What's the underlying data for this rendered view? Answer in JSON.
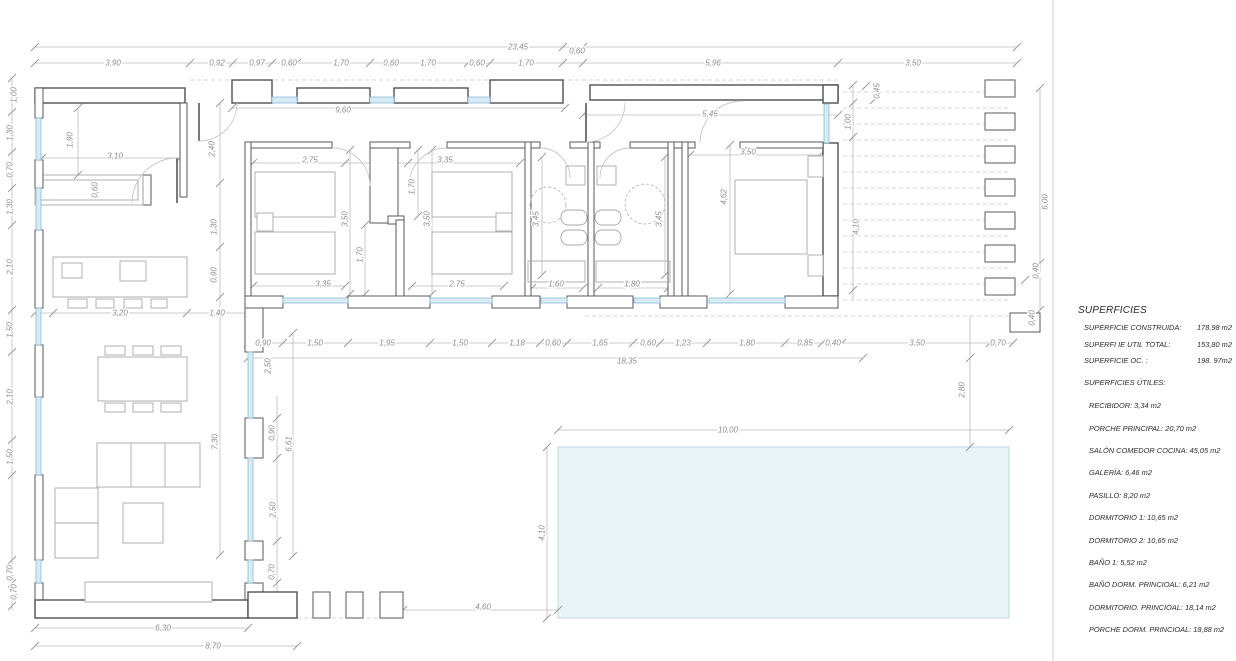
{
  "superficies": {
    "title": "SUPERFICIES",
    "summary": [
      {
        "label": "SUPERFICIE CONSTRUIDA:",
        "value": "178.98 m2"
      },
      {
        "label": "SUPERFI IE UTIL TOTAL:",
        "value": "153,80 m2"
      },
      {
        "label": "SUPERFICIE  OC. :",
        "value": "198. 97m2"
      }
    ],
    "utiles_title": "SUPERFICIES ÚTILES:",
    "rooms": [
      "RECIBIDOR: 3,34 m2",
      "PORCHE PRINCIPAL: 20,70 m2",
      "SALÓN COMEDOR COCINA: 45,05 m2",
      "GALERÍA: 6,46 m2",
      "PASILLO: 8,20 m2",
      "DORMITORIO 1: 10,65 m2",
      "DORMITORIO 2: 10,65 m2",
      "BAÑO 1: 5,52 m2",
      "BAÑO DORM. PRINCIOAL: 6,21 m2",
      "DORMITORIO. PRINCIOAL: 18,14 m2",
      "PORCHE DORM. PRINCIOAL: 18,88 m2"
    ]
  },
  "dimensions": [
    {
      "t": "23,45",
      "x": 518,
      "y": 47
    },
    {
      "t": "0,60",
      "x": 577,
      "y": 51
    },
    {
      "t": "3,90",
      "x": 113,
      "y": 63
    },
    {
      "t": "0,92",
      "x": 217,
      "y": 63
    },
    {
      "t": "0,97",
      "x": 257,
      "y": 63
    },
    {
      "t": "0,60",
      "x": 289,
      "y": 63
    },
    {
      "t": "1,70",
      "x": 341,
      "y": 63
    },
    {
      "t": "0,60",
      "x": 391,
      "y": 63
    },
    {
      "t": "1,70",
      "x": 428,
      "y": 63
    },
    {
      "t": "0,60",
      "x": 477,
      "y": 63
    },
    {
      "t": "1,70",
      "x": 526,
      "y": 63
    },
    {
      "t": "5,96",
      "x": 713,
      "y": 63
    },
    {
      "t": "3,50",
      "x": 913,
      "y": 63
    },
    {
      "t": "9,60",
      "x": 343,
      "y": 110
    },
    {
      "t": "5,45",
      "x": 710,
      "y": 114
    },
    {
      "t": "1,00",
      "x": 14,
      "y": 95,
      "r": -90
    },
    {
      "t": "1,30",
      "x": 10,
      "y": 133,
      "r": -90
    },
    {
      "t": "0,70",
      "x": 10,
      "y": 170,
      "r": -90
    },
    {
      "t": "1,30",
      "x": 10,
      "y": 207,
      "r": -90
    },
    {
      "t": "2,10",
      "x": 10,
      "y": 267,
      "r": -90
    },
    {
      "t": "1,50",
      "x": 10,
      "y": 330,
      "r": -90
    },
    {
      "t": "2,10",
      "x": 10,
      "y": 397,
      "r": -90
    },
    {
      "t": "1,50",
      "x": 10,
      "y": 457,
      "r": -90
    },
    {
      "t": "0,70",
      "x": 10,
      "y": 573,
      "r": -90
    },
    {
      "t": "0,70",
      "x": 14,
      "y": 592,
      "r": -90
    },
    {
      "t": "1,90",
      "x": 70,
      "y": 140,
      "r": -90
    },
    {
      "t": "3,10",
      "x": 115,
      "y": 156
    },
    {
      "t": "0,60",
      "x": 95,
      "y": 190,
      "r": -90
    },
    {
      "t": "2,40",
      "x": 212,
      "y": 149,
      "r": -90
    },
    {
      "t": "1,30",
      "x": 214,
      "y": 227,
      "r": -90
    },
    {
      "t": "0,90",
      "x": 214,
      "y": 275,
      "r": -90
    },
    {
      "t": "3,20",
      "x": 120,
      "y": 313
    },
    {
      "t": "1,40",
      "x": 217,
      "y": 313
    },
    {
      "t": "2,75",
      "x": 310,
      "y": 160
    },
    {
      "t": "3,35",
      "x": 445,
      "y": 160
    },
    {
      "t": "3,50",
      "x": 345,
      "y": 219,
      "r": -90
    },
    {
      "t": "1,70",
      "x": 412,
      "y": 187,
      "r": -90
    },
    {
      "t": "3,50",
      "x": 427,
      "y": 219,
      "r": -90
    },
    {
      "t": "1,70",
      "x": 360,
      "y": 255,
      "r": -90
    },
    {
      "t": "3,35",
      "x": 323,
      "y": 284
    },
    {
      "t": "2,75",
      "x": 457,
      "y": 284
    },
    {
      "t": "3,45",
      "x": 536,
      "y": 219,
      "r": -90
    },
    {
      "t": "3,45",
      "x": 659,
      "y": 219,
      "r": -90
    },
    {
      "t": "1,60",
      "x": 556,
      "y": 284
    },
    {
      "t": "1,80",
      "x": 632,
      "y": 284
    },
    {
      "t": "3,50",
      "x": 748,
      "y": 152
    },
    {
      "t": "4,62",
      "x": 724,
      "y": 197,
      "r": -90
    },
    {
      "t": "0,90",
      "x": 263,
      "y": 343
    },
    {
      "t": "1,50",
      "x": 315,
      "y": 343
    },
    {
      "t": "1,95",
      "x": 387,
      "y": 343
    },
    {
      "t": "1,50",
      "x": 460,
      "y": 343
    },
    {
      "t": "1,18",
      "x": 517,
      "y": 343
    },
    {
      "t": "0,60",
      "x": 553,
      "y": 343
    },
    {
      "t": "1,65",
      "x": 600,
      "y": 343
    },
    {
      "t": "0,60",
      "x": 648,
      "y": 343
    },
    {
      "t": "1,23",
      "x": 683,
      "y": 343
    },
    {
      "t": "1,80",
      "x": 747,
      "y": 343
    },
    {
      "t": "0,85",
      "x": 805,
      "y": 343
    },
    {
      "t": "0,40",
      "x": 833,
      "y": 343
    },
    {
      "t": "3,50",
      "x": 917,
      "y": 343
    },
    {
      "t": "0,70",
      "x": 998,
      "y": 343
    },
    {
      "t": "18,35",
      "x": 627,
      "y": 361
    },
    {
      "t": "2,50",
      "x": 268,
      "y": 366,
      "r": -90
    },
    {
      "t": "0,40",
      "x": 1032,
      "y": 318,
      "r": -90
    },
    {
      "t": "2,80",
      "x": 962,
      "y": 390,
      "r": -90
    },
    {
      "t": "7,30",
      "x": 215,
      "y": 442,
      "r": -90
    },
    {
      "t": "0,90",
      "x": 272,
      "y": 433,
      "r": -90
    },
    {
      "t": "6,61",
      "x": 289,
      "y": 444,
      "r": -90
    },
    {
      "t": "2,50",
      "x": 273,
      "y": 510,
      "r": -90
    },
    {
      "t": "0,70",
      "x": 272,
      "y": 572,
      "r": -90
    },
    {
      "t": "6,30",
      "x": 163,
      "y": 628
    },
    {
      "t": "8,70",
      "x": 213,
      "y": 646
    },
    {
      "t": "4,60",
      "x": 483,
      "y": 607
    },
    {
      "t": "10,00",
      "x": 728,
      "y": 430
    },
    {
      "t": "4,10",
      "x": 542,
      "y": 533,
      "r": -90
    },
    {
      "t": "0,45",
      "x": 877,
      "y": 91,
      "r": -90
    },
    {
      "t": "1,00",
      "x": 848,
      "y": 122,
      "r": -90
    },
    {
      "t": "4,10",
      "x": 856,
      "y": 227,
      "r": -90
    },
    {
      "t": "6,00",
      "x": 1045,
      "y": 202,
      "r": -90
    },
    {
      "t": "0,40",
      "x": 1036,
      "y": 271,
      "r": -90
    }
  ]
}
